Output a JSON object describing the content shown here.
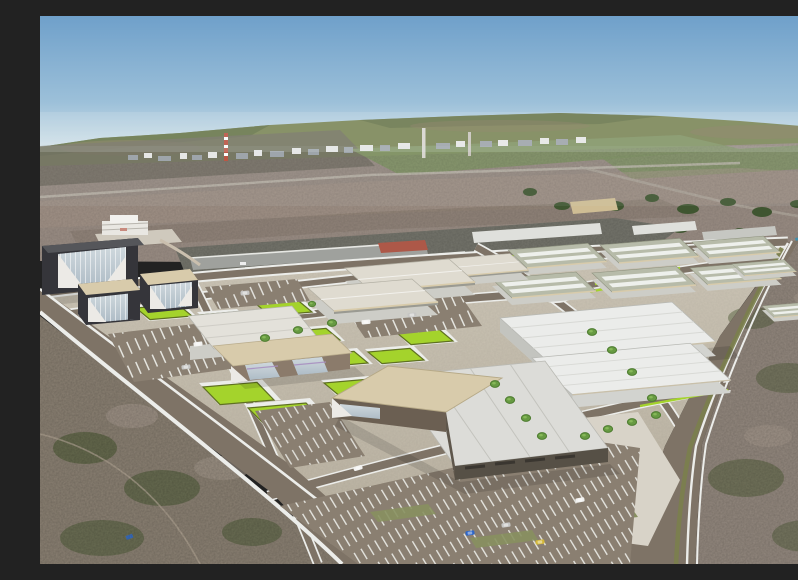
{
  "scene": {
    "type": "3d-aerial-masterplan-render",
    "description": "Aerial 3D rendering of a planned industrial park: dark glass office towers, a tan-roofed showroom, large warehouses and rows of flat industrial units with skylights, lime-green landscaped plots, parking lots with cars, a roundabout and tree-lined avenues inside boundary and perimeter roads, set on aerial-photo terrain with an existing freight yard, a distant village with a red-and-white smokestack, green hills and blue sky.",
    "elements": [
      "sky",
      "hills",
      "village",
      "smokestack",
      "existing-freight-yard",
      "office-towers",
      "showroom",
      "warehouses",
      "industrial-units",
      "roundabout",
      "green-plots",
      "parking-lots",
      "boundary-road",
      "perimeter-road",
      "scrubland"
    ],
    "counts": {
      "office_towers": 3,
      "large_warehouses": 4,
      "medium_warehouses": 3,
      "industrial_units": 8,
      "green_plots": 11,
      "cars": 10,
      "trees": 16,
      "roundabouts": 1,
      "smokestacks": 2
    }
  },
  "palette": {
    "sky_top": "#6fa0ca",
    "sky_mid": "#9cc0d9",
    "sky_horizon": "#d3e2e9",
    "hills_green": "#75804e",
    "hills_dark": "#5c6a3e",
    "hills_brown": "#84765a",
    "fields": "#9a8d84",
    "field_green": "#7e9060",
    "field_dark": "#6e6a5e",
    "town_light": "#e8e8e6",
    "town_gray": "#9aa0a6",
    "chimney_red": "#b84b38",
    "chimney_pale": "#d8d5cf",
    "tree_photo": "#3f5530",
    "water": "#3e8fae",
    "strip_ground": "#75756c",
    "shed_gray": "#9fa19d",
    "shed_light": "#c6c7c2",
    "shed_white": "#dfe0dc",
    "shed_red": "#ad5848",
    "shed_tan": "#cfbd94",
    "ground_hi": "#cdc6b7",
    "ground_lo": "#b9b1a0",
    "terrain": "#8b8173",
    "terrain_right": "#93887e",
    "scrub_dark": "#55603d",
    "scrub_light": "#a79a8e",
    "road": "#7e7366",
    "lot": "#8a7f71",
    "curb": "#ecedea",
    "verge_olive": "#7b7f4d",
    "lawn_olive": "#87905f",
    "plot_lime": "#a4d32c",
    "plot_border": "#5f7022",
    "concrete": "#d8d3c8",
    "tower_dark": "#35353a",
    "tower_roof": "#55565a",
    "roof_tan": "#d8cbab",
    "glass_hi": "#cfd8dd",
    "glass_lo": "#aebcc6",
    "glass_violet": "#a98fc0",
    "wall_brown": "#8b7b6b",
    "wall_dark": "#5e564b",
    "roof_light": "#dcdcd8",
    "roof_white": "#ebecea",
    "roof_cream": "#dfdbd0",
    "wall_light": "#cdcdc7",
    "unit_roof": "#b7bba9",
    "skylight": "#eef0ec",
    "tree_green": "#679a42",
    "tree_core": "#4d7c2f",
    "car_white": "#f2f2f0",
    "car_silver": "#c6c6c4",
    "car_blue": "#2e66c8",
    "car_yellow": "#d4b83a"
  }
}
